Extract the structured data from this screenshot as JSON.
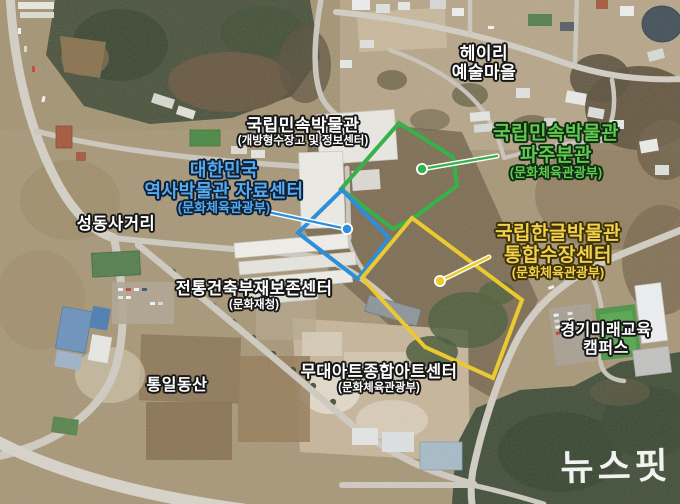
{
  "palette": {
    "label_white": "#ffffff",
    "label_outline": "#141414",
    "green_overlay": "#35b24a",
    "blue_overlay": "#2e8ed9",
    "yellow_overlay": "#ebc930"
  },
  "labels": {
    "heyri": {
      "line1": "헤이리",
      "line2": "예술마을"
    },
    "folk_storage": {
      "line1": "국립민속박물관",
      "line2": "(개방형수장고 및 정보센터)"
    },
    "folk_paju": {
      "line1": "국립민속박물관",
      "line2": "파주분관",
      "line3": "(문화체육관광부)"
    },
    "history": {
      "line1": "대한민국",
      "line2": "역사박물관 자료센터",
      "line3": "(문화체육관광부)"
    },
    "seongdong": {
      "line1": "성동사거리"
    },
    "hangeul": {
      "line1": "국립한글박물관",
      "line2": "통합수장센터",
      "line3": "(문화체육관광부)"
    },
    "tradition": {
      "line1": "전통건축부재보존센터",
      "line2": "(문화재청)"
    },
    "campus": {
      "line1": "경기미래교육",
      "line2": "캠퍼스"
    },
    "tongil": {
      "line1": "통일동산"
    },
    "stage_art": {
      "line1": "무대아트종합아트센터",
      "line2": "(문화체육관광부)"
    },
    "watermark": "뉴스핏"
  },
  "overlays": {
    "folk_paju_site": {
      "color": "#35b24a",
      "label_color": "#62c94f",
      "polygon": [
        [
          399,
          123
        ],
        [
          453,
          157
        ],
        [
          457,
          186
        ],
        [
          412,
          219
        ],
        [
          393,
          229
        ],
        [
          341,
          189
        ]
      ],
      "dot": [
        422,
        169
      ],
      "pointer_end": [
        497,
        156
      ]
    },
    "history_site": {
      "color": "#2e8ed9",
      "label_color": "#58a8ec",
      "polygon": [
        [
          342,
          190
        ],
        [
          389,
          238
        ],
        [
          358,
          279
        ],
        [
          298,
          233
        ]
      ],
      "dot": [
        347,
        229
      ],
      "pointer_end": [
        268,
        212
      ]
    },
    "hangeul_site": {
      "color": "#ebc930",
      "label_color": "#f2d14d",
      "polygon": [
        [
          412,
          218
        ],
        [
          522,
          300
        ],
        [
          493,
          378
        ],
        [
          425,
          347
        ],
        [
          362,
          278
        ]
      ],
      "dot": [
        440,
        281
      ],
      "pointer_end": [
        489,
        257
      ]
    }
  }
}
